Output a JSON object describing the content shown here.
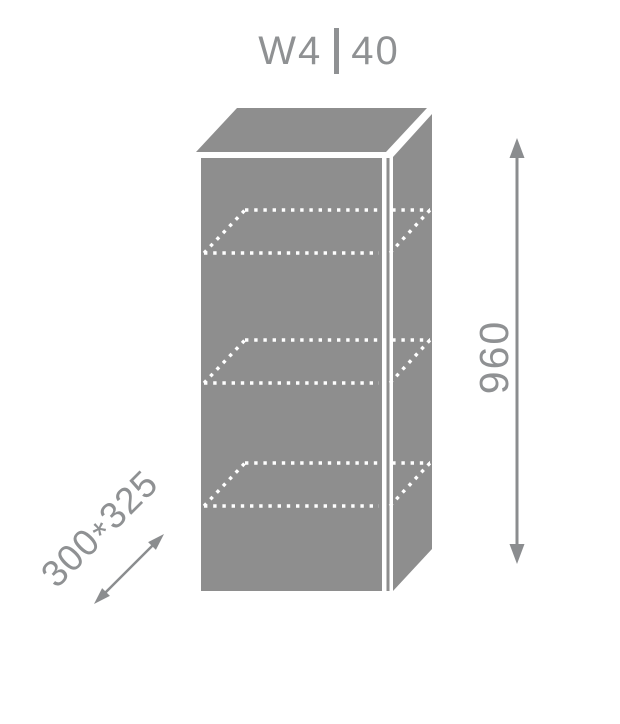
{
  "colors": {
    "background": "#ffffff",
    "cabinet_gray": "#8e8e8e",
    "label_gray": "#8f9193",
    "arrow_gray": "#8b8d8f",
    "shelf_dot_color": "#ffffff"
  },
  "header": {
    "series_code": "W4",
    "size_code": "40"
  },
  "drawing": {
    "height_dimension_mm": "960",
    "depth_dimension": {
      "depth_mm": "300",
      "separator": "*",
      "width_mm": "325"
    },
    "shelf_count": 3
  }
}
